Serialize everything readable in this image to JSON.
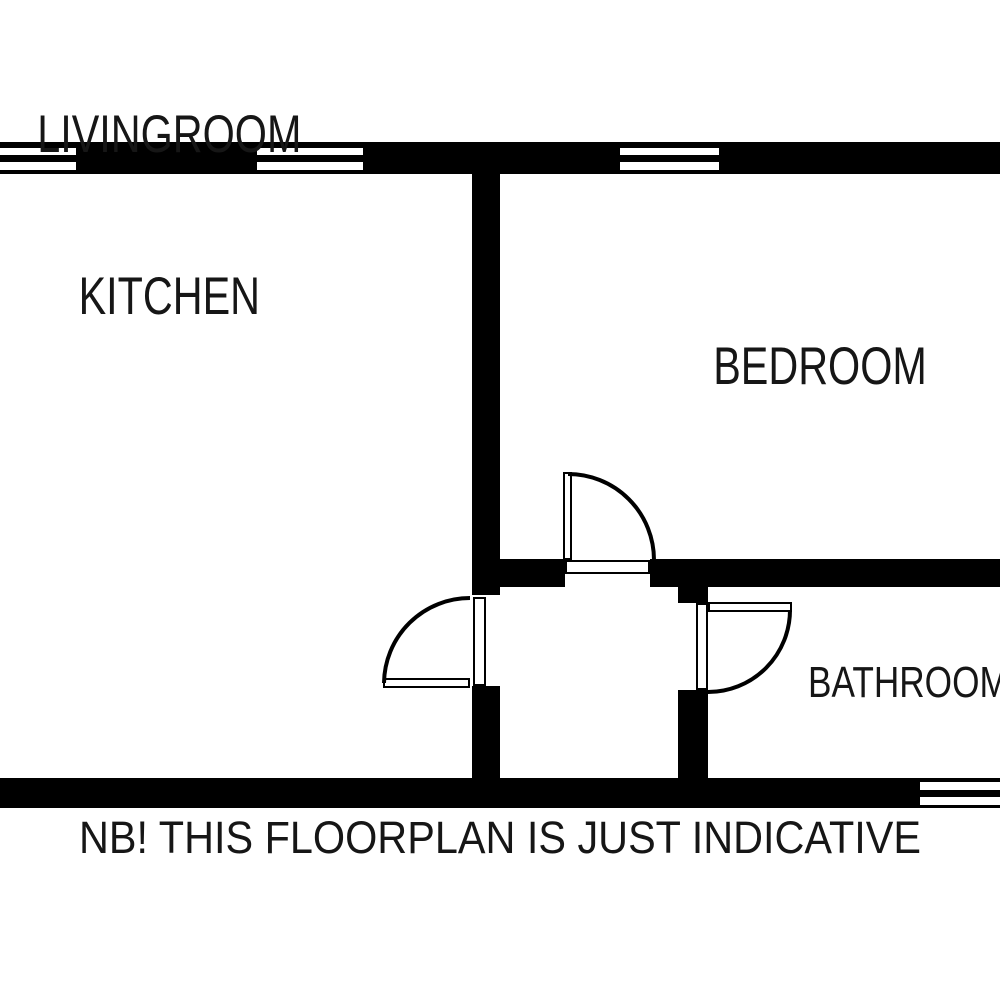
{
  "colors": {
    "wall": "#000000",
    "background": "#ffffff",
    "text": "#161616"
  },
  "labels": {
    "room1_line1": "LIVINGROOM",
    "room1_line2": "KITCHEN",
    "room2": "BEDROOM",
    "room3": "BATHROOM",
    "disclaimer": "NB! THIS FLOORPLAN IS JUST INDICATIVE"
  },
  "floorplan": {
    "walls": [
      {
        "x": 0,
        "y": 142,
        "w": 1000,
        "h": 32
      },
      {
        "x": 0,
        "y": 778,
        "w": 1000,
        "h": 30
      },
      {
        "x": 472,
        "y": 174,
        "w": 28,
        "h": 421
      },
      {
        "x": 472,
        "y": 686,
        "w": 28,
        "h": 92
      },
      {
        "x": 500,
        "y": 559,
        "w": 65,
        "h": 28
      },
      {
        "x": 650,
        "y": 559,
        "w": 350,
        "h": 28
      },
      {
        "x": 678,
        "y": 587,
        "w": 30,
        "h": 16
      },
      {
        "x": 678,
        "y": 690,
        "w": 30,
        "h": 88
      }
    ],
    "windows": [
      {
        "x": -6,
        "y": 146,
        "w": 84,
        "h": 26
      },
      {
        "x": 255,
        "y": 146,
        "w": 110,
        "h": 26
      },
      {
        "x": 618,
        "y": 146,
        "w": 103,
        "h": 26
      },
      {
        "x": 918,
        "y": 780,
        "w": 88,
        "h": 27
      }
    ],
    "door_frames": [
      {
        "x": 473,
        "y": 597,
        "w": 13,
        "h": 89
      },
      {
        "x": 565,
        "y": 560,
        "w": 85,
        "h": 14
      },
      {
        "x": 696,
        "y": 603,
        "w": 12,
        "h": 87
      }
    ],
    "door_leaves": [
      {
        "x": 383,
        "y": 678,
        "w": 87,
        "h": 10
      },
      {
        "x": 563,
        "y": 472,
        "w": 9,
        "h": 88
      },
      {
        "x": 708,
        "y": 602,
        "w": 84,
        "h": 10
      }
    ],
    "door_arcs": [
      {
        "d": "M 384 683 A 86 86 0 0 1 470 598"
      },
      {
        "d": "M 568 474 A 86 86 0 0 1 654 560"
      },
      {
        "d": "M 790 610 A 82 82 0 0 1 708 692"
      }
    ]
  }
}
